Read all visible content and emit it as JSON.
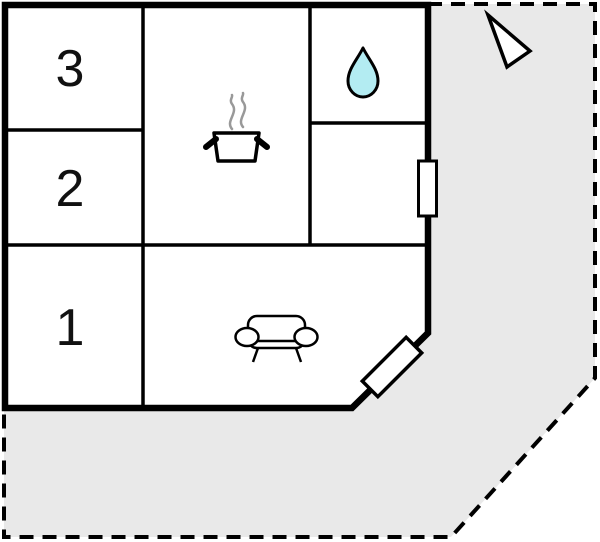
{
  "floor_plan": {
    "title": "holiday-home floor plan",
    "rooms": [
      {
        "name": "room-3",
        "label": "3"
      },
      {
        "name": "room-2",
        "label": "2"
      },
      {
        "name": "room-1",
        "label": "1"
      }
    ],
    "symbols": [
      {
        "name": "cooking-pot-icon",
        "meaning": "kitchen"
      },
      {
        "name": "water-drop-icon",
        "meaning": "bathroom"
      },
      {
        "name": "sofa-icon",
        "meaning": "living room"
      },
      {
        "name": "window-marker",
        "meaning": "window"
      },
      {
        "name": "door-marker",
        "meaning": "entrance door"
      },
      {
        "name": "north-arrow-icon",
        "meaning": "orientation arrow"
      }
    ],
    "colors": {
      "plot_fill": "#e9e9e9",
      "wall": "#000000",
      "interior_fill": "#ffffff",
      "water_drop_fill": "#b3ecf2",
      "steam": "#999999"
    }
  }
}
